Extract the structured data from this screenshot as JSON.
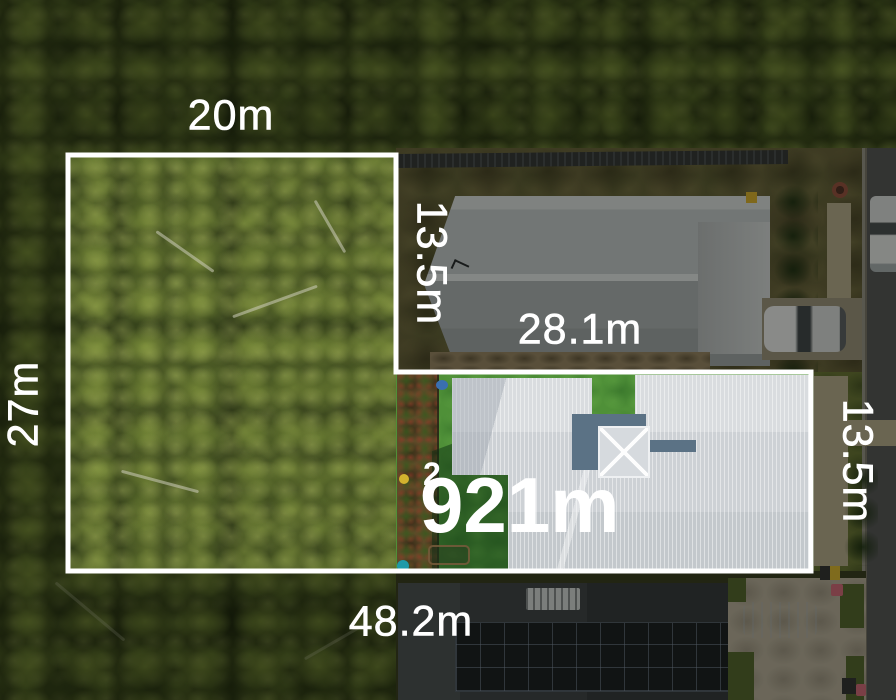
{
  "measurements": {
    "top": {
      "text": "20m"
    },
    "left": {
      "text": "27m"
    },
    "inner": {
      "text": "13.5m"
    },
    "step": {
      "text": "28.1m"
    },
    "right": {
      "text": "13.5m"
    },
    "bottom": {
      "text": "48.2m"
    }
  },
  "area": {
    "value": "921m",
    "superscript": "2"
  },
  "colors": {
    "annotation_white": "#ffffff",
    "lot_lawn_green": "#4f9038",
    "lot_house_roof": "#ced2d6",
    "blue_roof_section": "#5b7285",
    "neighbor_roof_gray": "#a5a8ab",
    "dark_roof_charcoal": "#34383c",
    "solar_panel": "#171a20",
    "road_asphalt": "#4e4e50",
    "concrete_path": "#a79d82",
    "forest_dark": "#252c11",
    "forest_bright": "#6a7a35"
  }
}
